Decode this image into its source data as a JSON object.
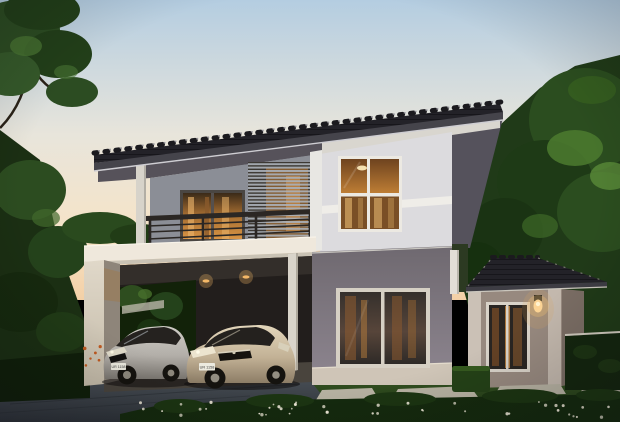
{
  "meta": {
    "title": "Two-storey modern house exterior — 3D architectural rendering at dusk"
  },
  "scene": {
    "sky": "dusk gradient from pale blue to warm peach at the horizon",
    "house": {
      "storeys": 2,
      "style": "modern contemporary render",
      "roof": "dark grey mono-pitch tiled main roof, hipped tiled roof on single-storey annex",
      "features": [
        "second-floor balcony with dark metal railing",
        "grey louvre privacy screen with warm light behind",
        "warm-lit windows and sliding glass doors",
        "double carport under second-floor overhang",
        "cream carport pier wall and white columns",
        "single-storey annex wing with wall sconce lamp"
      ]
    },
    "vehicles": [
      {
        "position": "left",
        "type": "sedan",
        "color": "silver",
        "license_plate": "UR 1158"
      },
      {
        "position": "right",
        "type": "sedan",
        "color": "champagne beige",
        "license_plate": "UR 1158"
      }
    ],
    "landscape": [
      "mature trees left and right",
      "trimmed hedge fences",
      "dark green lawn",
      "white flower bed in the foreground",
      "concrete stepping stones",
      "grey driveway",
      "trimmed box shrub"
    ],
    "lighting": [
      "warm interior light in all windows",
      "recessed carport ceiling downlights",
      "glowing wall lamp on annex"
    ]
  },
  "flower_detail": {
    "count": 42,
    "accent_count": 6
  },
  "colors": {
    "sky_top": "#b4cde1",
    "sky_mid": "#e8e5db",
    "sky_low": "#f6e3c7",
    "sky_horizon": "#f3d0a6",
    "roof_tile": "#232228",
    "roof_fascia": "#45444b",
    "roof_edge": "#cecdd2",
    "ridge": "#1b1a1e",
    "soffit_dark": "#56525a",
    "soffit_light": "#d9d6cf",
    "gable_shadow": "#55525c",
    "wall_white": "#dcdbde",
    "wall_band": "#efede8",
    "wall_grey": "#8b8e96",
    "wall_mauve": "#7d767e",
    "wall_mauve_dark": "#6f6970",
    "corner_trim": "#e8e7e3",
    "column_white": "#d7d3ca",
    "band_cream": "#efe8dc",
    "band_shadow": "#c9c2b4",
    "slab_cream": "#d9d1c2",
    "slab_shade": "#8e857a",
    "carport_ceiling": "#332e2a",
    "carport_back": "#221e1c",
    "carport_floor": "#5d584f",
    "annex_wall": "#97897f",
    "annex_side": "#7a6d64",
    "annex_pilaster": "#cbc1b6",
    "frame_white": "#d9d3c9",
    "glass_dark": "#292522",
    "glass_warm": "#c07f35",
    "glass_warm_bright": "#e9a859",
    "curtain": "#c89a5c",
    "railing": "#2b2724",
    "louver_slat": "#aab0b8",
    "louver_gap": "#3a3630",
    "tree_dark": "#1d3517",
    "tree_mid": "#2c4d1f",
    "tree_light": "#4c7b2f",
    "tree_highlight": "#5d8f3b",
    "lawn": "#35521f",
    "lawn_dark": "#1c3114",
    "hedge": "#14260f",
    "hedge_rail": "#cfc9bd",
    "flower": "#efe9d8",
    "flower_accent": "#c05a20",
    "stone": "#b7b2a2",
    "driveway": "#41464d",
    "driveway_dark": "#30353b",
    "car_silver": "#b5b1ab",
    "car_silver_dark": "#7b7771",
    "car_champagne": "#cdbda1",
    "car_champagne_dark": "#8c7d66",
    "tire": "#15130f",
    "hub": "#8e897d",
    "plate_bg": "#eceadf",
    "plate_text": "#3a3a3a",
    "lamp_glow": "#f4c070",
    "light_warm": "#f4b868"
  }
}
